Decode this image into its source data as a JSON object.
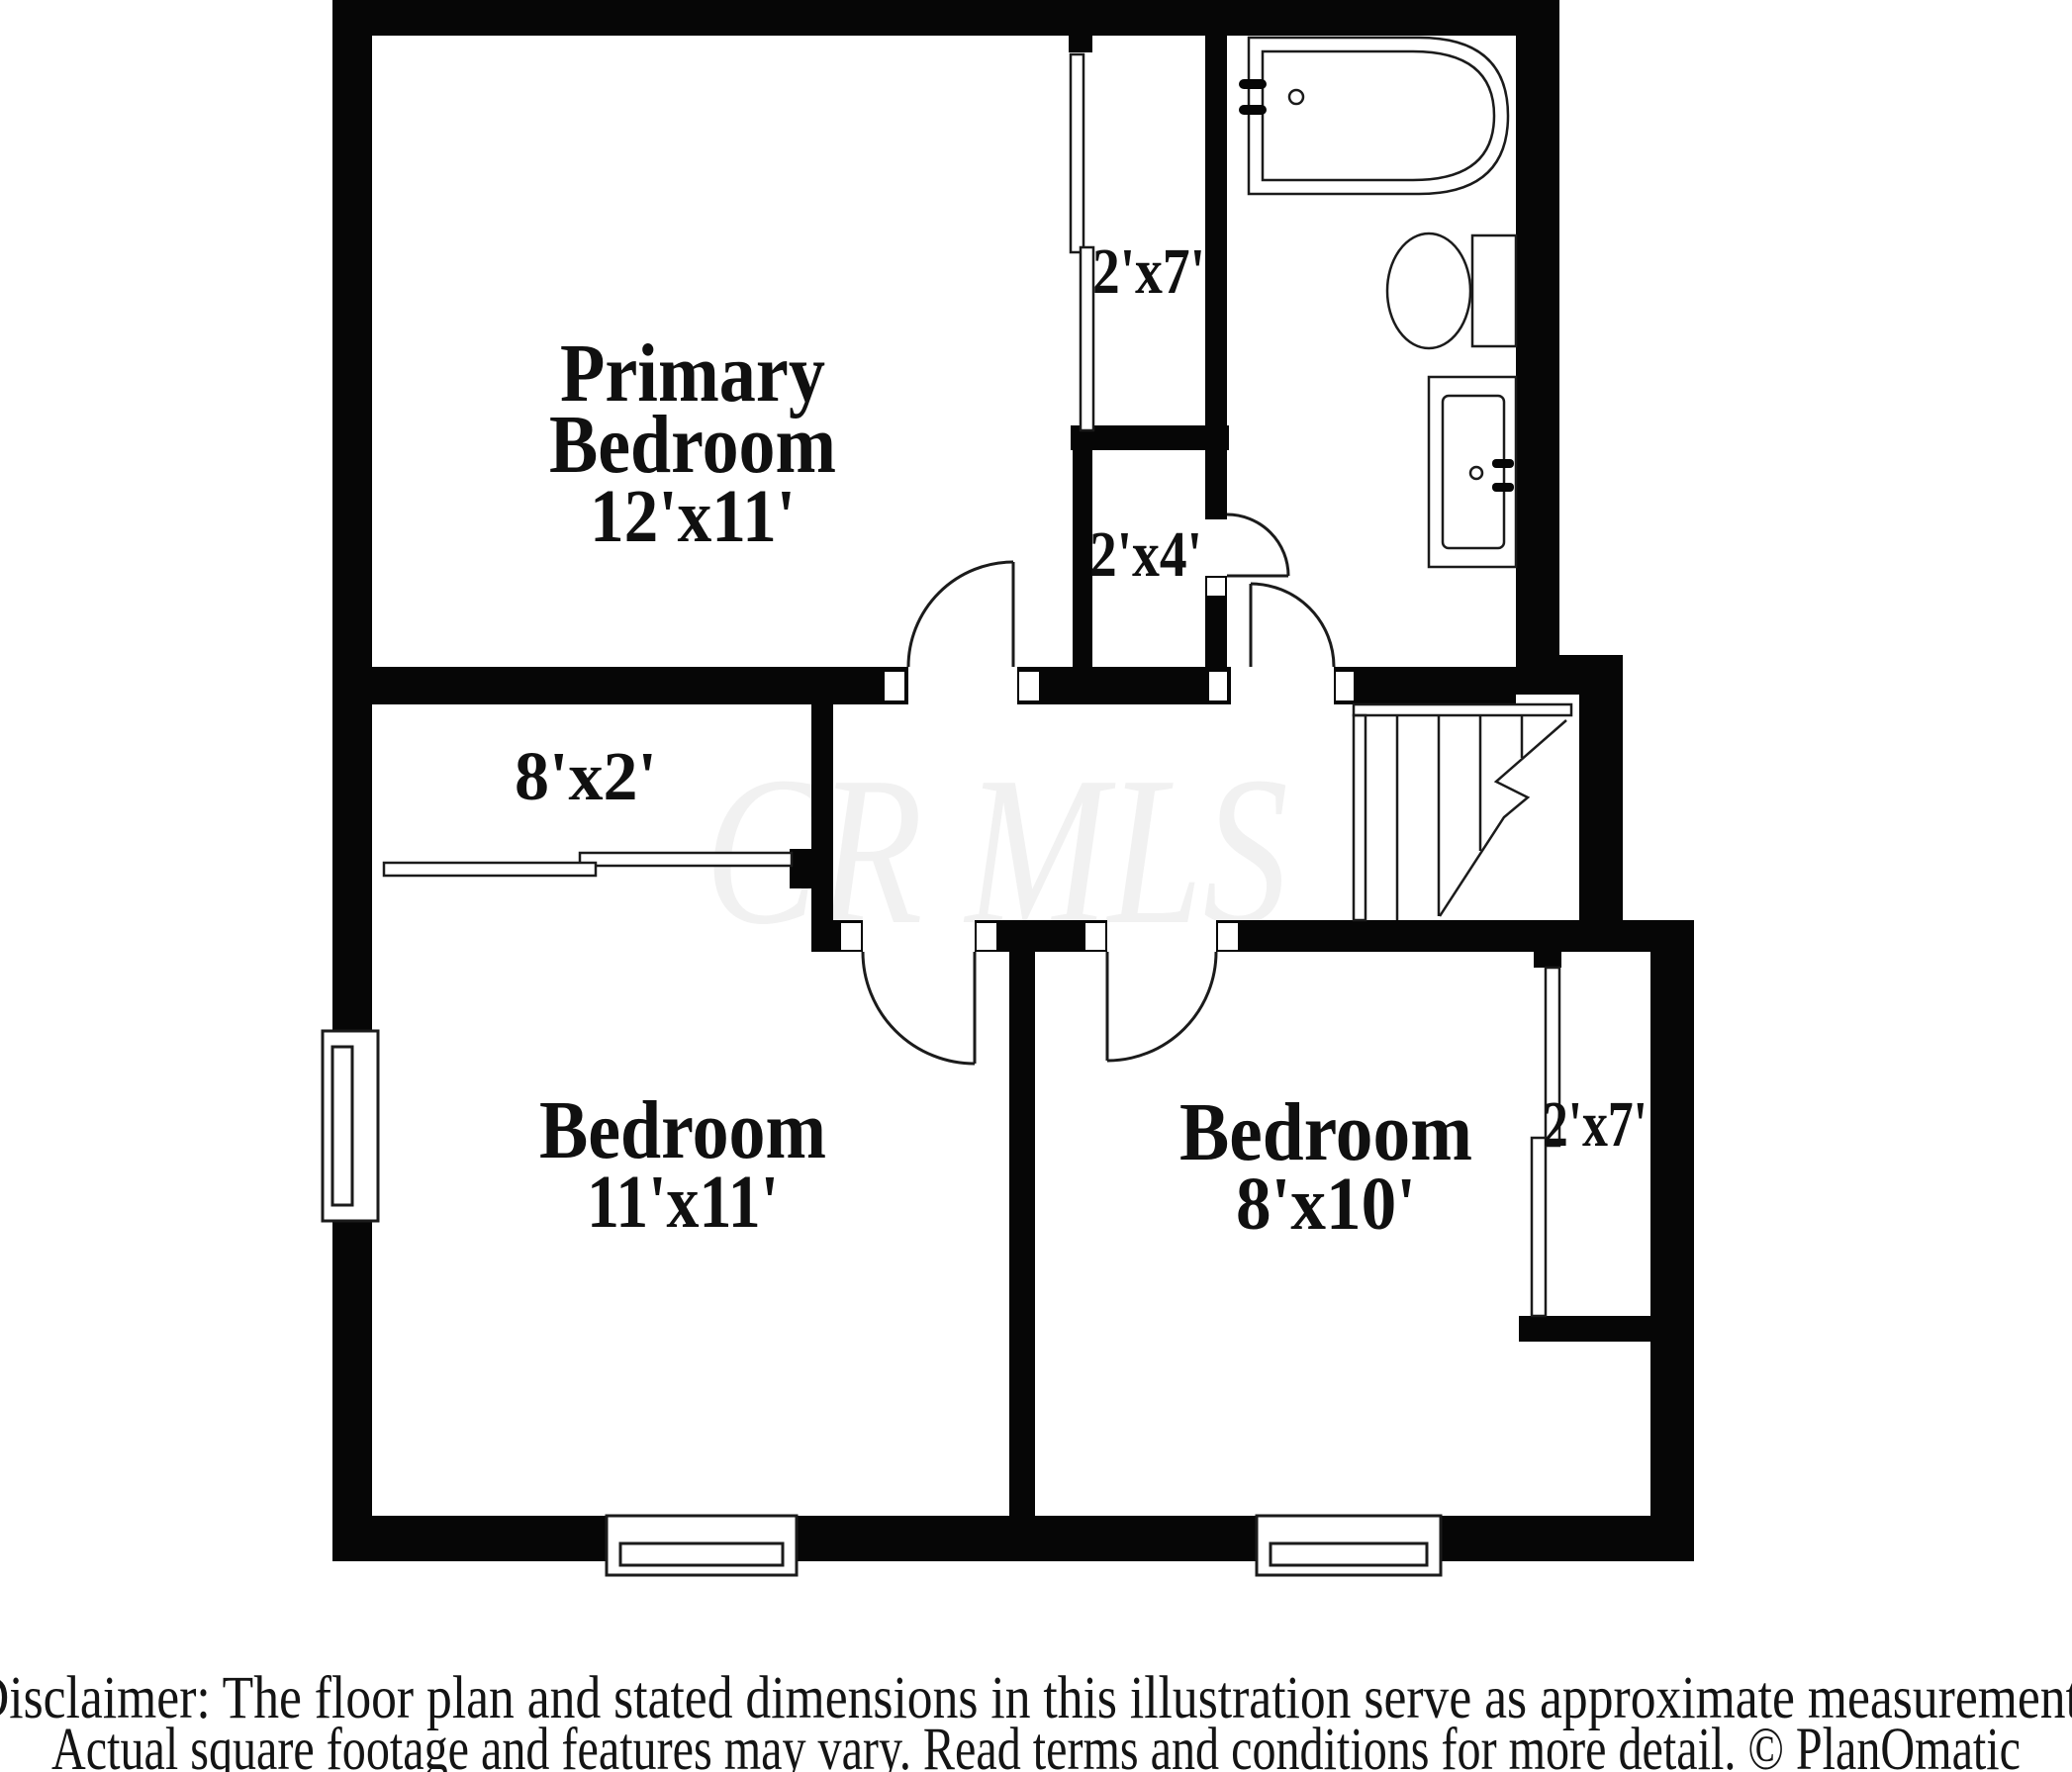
{
  "plan": {
    "watermark": "CR MLS",
    "rooms": [
      {
        "id": "primary-bedroom",
        "lines": [
          "Primary",
          "Bedroom"
        ],
        "dims": "12'x11'"
      },
      {
        "id": "bedroom-left",
        "lines": [
          "Bedroom"
        ],
        "dims": "11'x11'"
      },
      {
        "id": "bedroom-right",
        "lines": [
          "Bedroom"
        ],
        "dims": "8'x10'"
      }
    ],
    "closets": [
      {
        "id": "primary-closet",
        "dims": "2'x7'"
      },
      {
        "id": "hall-closet",
        "dims": "2'x4'"
      },
      {
        "id": "primary-wall-closet",
        "dims": "8'x2'"
      },
      {
        "id": "bedroom-right-closet",
        "dims": "2'x7'"
      }
    ],
    "fixtures": [
      {
        "id": "bathtub"
      },
      {
        "id": "toilet"
      },
      {
        "id": "sink-vanity"
      },
      {
        "id": "staircase"
      }
    ],
    "footer": {
      "line1": "Disclaimer: The floor plan and stated dimensions in this illustration serve as approximate measurements",
      "line2": "Actual square footage and features may vary. Read terms and conditions for more detail. © PlanOmatic"
    },
    "colors": {
      "wall": "#060606",
      "background": "#ffffff",
      "watermark": "#f1f1f1",
      "label_text": "#101010",
      "fixture_line": "#1b1b1b"
    }
  }
}
